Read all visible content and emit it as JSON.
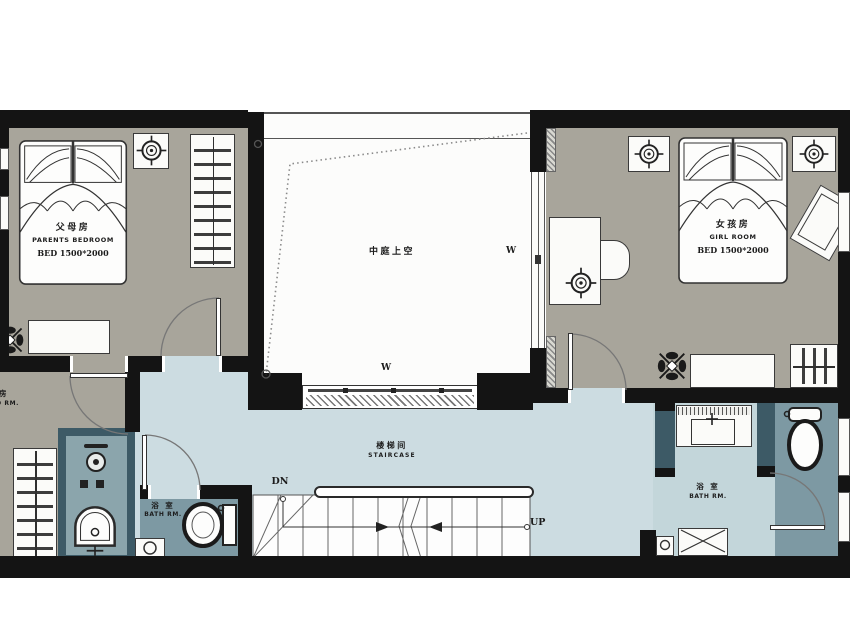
{
  "plan": {
    "title_note": "second floor residential plan",
    "parents_bedroom": {
      "cn": "父母房",
      "en": "PARENTS BEDROOM",
      "bed_size": "BED 1500*2000"
    },
    "girl_room": {
      "cn": "女孩房",
      "en": "GIRL ROOM",
      "bed_size": "BED 1500*2000"
    },
    "atrium": {
      "cn": "中庭上空"
    },
    "staircase": {
      "cn": "楼梯间",
      "en": "STAIRCASE",
      "down_label": "DN",
      "up_label": "UP"
    },
    "bath_left": {
      "cn": "浴 室",
      "en": "BATH RM."
    },
    "bath_right": {
      "cn": "浴 室",
      "en": "BATH RM."
    },
    "partial_room": {
      "cn": "人房",
      "en": "O RM."
    },
    "window_label": "W"
  },
  "colors": {
    "wall": "#141414",
    "bedroom_floor": "#a8a59b",
    "hallway_floor": "#ccdce1",
    "bath_floor_light": "#8ca6ad",
    "bath_floor_dark": "#7d99a3",
    "partition_teal": "#3d5a66",
    "atrium_white": "#fcfcfb"
  }
}
